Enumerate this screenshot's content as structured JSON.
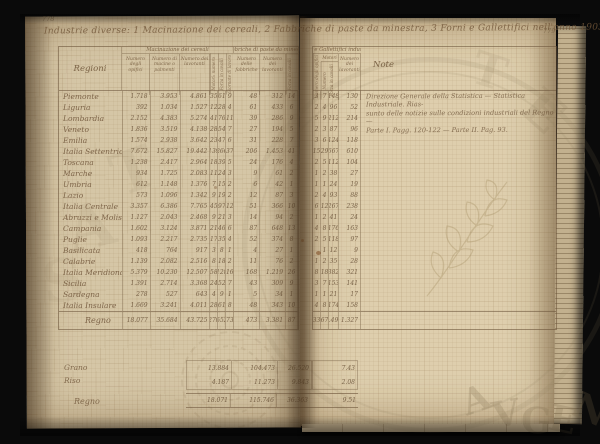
{
  "photo": {
    "background": "#0a0a0a",
    "page_color": "#d5c6a6",
    "ink_color": "#6f5a40",
    "line_color": "#685036",
    "seal_color": "#7d6b4c"
  },
  "pages": {
    "left_number": "778",
    "right_number": "779"
  },
  "title": "Industrie diverse: 1 Macinazione dei cereali, 2 Fabbriche di paste da minestra, 3 Forni e Gallettifici nell'anno 1903",
  "table": {
    "region_header": "Regioni",
    "motori_label": "Motori",
    "note_header": "Note",
    "groups": [
      {
        "label": "Macinazione dei cereali"
      },
      {
        "label": "Fabbriche di paste da minestra"
      },
      {
        "label": "Forni e Gallettifici industriali"
      }
    ],
    "columns_left": [
      {
        "label": "Numero degli opifici",
        "rotated": false
      },
      {
        "label": "Numero di macine o palmenti",
        "rotated": false
      },
      {
        "label": "Numero dei lavoranti",
        "rotated": false
      },
      {
        "label": "Motori: numero",
        "rotated": true
      },
      {
        "label": "Forza in cavalli",
        "rotated": true
      },
      {
        "label": "Giornate di lavoro",
        "rotated": true
      },
      {
        "label": "Numero delle fabbriche",
        "rotated": false
      },
      {
        "label": "Numero dei lavoranti",
        "rotated": false
      },
      {
        "label": "Forza in cavalli",
        "rotated": true
      }
    ],
    "columns_right": [
      {
        "label": "Numero degli opifici",
        "rotated": true
      },
      {
        "label": "Numero",
        "rotated": true
      },
      {
        "label": "Forza in cavalli",
        "rotated": true
      },
      {
        "label": "Numero dei lavoranti",
        "rotated": false
      }
    ],
    "rows": [
      {
        "region": "Piemonte",
        "left": [
          "1.718",
          "3.953",
          "4.861",
          "35",
          "61",
          "9",
          "48",
          "312",
          "14"
        ],
        "right": [
          "3",
          "7",
          "148",
          "130"
        ]
      },
      {
        "region": "Liguria",
        "left": [
          "392",
          "1.034",
          "1.527",
          "12",
          "28",
          "4",
          "61",
          "433",
          "6"
        ],
        "right": [
          "2",
          "4",
          "96",
          "52"
        ]
      },
      {
        "region": "Lombardia",
        "left": [
          "2.152",
          "4.383",
          "5.274",
          "41",
          "76",
          "11",
          "39",
          "286",
          "9"
        ],
        "right": [
          "5",
          "9",
          "212",
          "214"
        ]
      },
      {
        "region": "Veneto",
        "left": [
          "1.836",
          "3.519",
          "4.138",
          "28",
          "54",
          "7",
          "27",
          "194",
          "5"
        ],
        "right": [
          "2",
          "3",
          "87",
          "96"
        ]
      },
      {
        "region": "Emilia",
        "left": [
          "1.574",
          "2.938",
          "3.642",
          "23",
          "47",
          "6",
          "31",
          "228",
          "7"
        ],
        "right": [
          "3",
          "6",
          "124",
          "118"
        ]
      },
      {
        "region": "Italia Settentrionale",
        "left": [
          "7.672",
          "15.827",
          "19.442",
          "139",
          "266",
          "37",
          "206",
          "1.453",
          "41"
        ],
        "right": [
          "15",
          "29",
          "667",
          "610"
        ]
      },
      {
        "region": "Toscana",
        "left": [
          "1.238",
          "2.417",
          "2.964",
          "18",
          "39",
          "5",
          "24",
          "176",
          "4"
        ],
        "right": [
          "2",
          "5",
          "112",
          "104"
        ]
      },
      {
        "region": "Marche",
        "left": [
          "934",
          "1.725",
          "2.083",
          "11",
          "24",
          "3",
          "9",
          "61",
          "2"
        ],
        "right": [
          "1",
          "2",
          "38",
          "27"
        ]
      },
      {
        "region": "Umbria",
        "left": [
          "612",
          "1.148",
          "1.376",
          "7",
          "15",
          "2",
          "6",
          "42",
          "1"
        ],
        "right": [
          "1",
          "1",
          "24",
          "19"
        ]
      },
      {
        "region": "Lazio",
        "left": [
          "573",
          "1.096",
          "1.342",
          "9",
          "19",
          "2",
          "12",
          "87",
          "3"
        ],
        "right": [
          "2",
          "4",
          "93",
          "88"
        ]
      },
      {
        "region": "Italia Centrale",
        "left": [
          "3.357",
          "6.386",
          "7.765",
          "45",
          "97",
          "12",
          "51",
          "366",
          "10"
        ],
        "right": [
          "6",
          "12",
          "267",
          "238"
        ]
      },
      {
        "region": "Abruzzi e Molise",
        "left": [
          "1.127",
          "2.043",
          "2.468",
          "9",
          "21",
          "3",
          "14",
          "94",
          "2"
        ],
        "right": [
          "1",
          "2",
          "41",
          "24"
        ]
      },
      {
        "region": "Campania",
        "left": [
          "1.602",
          "3.124",
          "3.871",
          "21",
          "46",
          "6",
          "87",
          "648",
          "13"
        ],
        "right": [
          "4",
          "8",
          "176",
          "163"
        ]
      },
      {
        "region": "Puglie",
        "left": [
          "1.093",
          "2.217",
          "2.735",
          "17",
          "35",
          "4",
          "52",
          "374",
          "8"
        ],
        "right": [
          "2",
          "5",
          "118",
          "97"
        ]
      },
      {
        "region": "Basilicata",
        "left": [
          "418",
          "764",
          "917",
          "3",
          "8",
          "1",
          "4",
          "27",
          "1"
        ],
        "right": [
          "",
          "1",
          "12",
          "9"
        ]
      },
      {
        "region": "Calabrie",
        "left": [
          "1.139",
          "2.082",
          "2.516",
          "8",
          "18",
          "2",
          "11",
          "76",
          "2"
        ],
        "right": [
          "1",
          "2",
          "35",
          "28"
        ]
      },
      {
        "region": "Italia Meridionale",
        "left": [
          "5.379",
          "10.230",
          "12.507",
          "58",
          "128",
          "16",
          "168",
          "1.219",
          "26"
        ],
        "right": [
          "8",
          "18",
          "382",
          "321"
        ]
      },
      {
        "region": "Sicilia",
        "left": [
          "1.391",
          "2.714",
          "3.368",
          "24",
          "52",
          "7",
          "43",
          "309",
          "9"
        ],
        "right": [
          "3",
          "7",
          "153",
          "141"
        ]
      },
      {
        "region": "Sardegna",
        "left": [
          "278",
          "527",
          "643",
          "4",
          "9",
          "1",
          "5",
          "34",
          "1"
        ],
        "right": [
          "1",
          "1",
          "21",
          "17"
        ]
      },
      {
        "region": "Italia Insulare",
        "left": [
          "1.669",
          "3.241",
          "4.011",
          "28",
          "61",
          "8",
          "48",
          "343",
          "10"
        ],
        "right": [
          "4",
          "8",
          "174",
          "158"
        ]
      }
    ],
    "total": {
      "region": "Regno",
      "left": [
        "18.077",
        "35.684",
        "43.725",
        "270",
        "552",
        "73",
        "473",
        "3.381",
        "87"
      ],
      "right": [
        "33",
        "67",
        "1.490",
        "1.327"
      ]
    }
  },
  "bottom_block": {
    "rows": [
      {
        "label": "Grano",
        "left": [
          "13.884",
          "104.473",
          "26.520"
        ],
        "right": "7.43"
      },
      {
        "label": "Riso",
        "left": [
          "4.187",
          "11.273",
          "9.843"
        ],
        "right": "2.08"
      }
    ],
    "total": {
      "label": "Regno",
      "left": [
        "18.071",
        "115.746",
        "36.363"
      ],
      "right": "9.51"
    }
  },
  "note_lines": [
    "Direzione Generale della Statistica — Statistica Industriale. Rias-",
    "sunto delle notizie sulle condizioni industriali del Regno —",
    "Parte I. Pagg. 120-122 — Parte II. Pag. 93."
  ],
  "seal": {
    "ring": {
      "cx": 430,
      "cy": 245,
      "r": 188
    },
    "letters": [
      {
        "ch": "T",
        "x": 472,
        "y": 48,
        "s": 46,
        "rot": 18,
        "o": 0.1
      },
      {
        "ch": "E",
        "x": 524,
        "y": 86,
        "s": 50,
        "rot": 42,
        "o": 0.13
      },
      {
        "ch": "A",
        "x": 462,
        "y": 382,
        "s": 36,
        "rot": -20,
        "o": 0.22
      },
      {
        "ch": "V",
        "x": 492,
        "y": 396,
        "s": 36,
        "rot": -10,
        "o": 0.22
      },
      {
        "ch": "G",
        "x": 521,
        "y": 403,
        "s": 36,
        "rot": 2,
        "o": 0.22
      },
      {
        "ch": "E",
        "x": 549,
        "y": 402,
        "s": 36,
        "rot": 12,
        "o": 0.22
      },
      {
        "ch": "N",
        "x": 574,
        "y": 392,
        "s": 36,
        "rot": 24,
        "o": 0.22
      },
      {
        "ch": "A",
        "x": 66,
        "y": 196,
        "s": 62,
        "rot": -14,
        "o": 0.08
      },
      {
        "ch": "T",
        "x": 112,
        "y": 142,
        "s": 58,
        "rot": -20,
        "o": 0.08
      },
      {
        "ch": "S",
        "x": 42,
        "y": 252,
        "s": 58,
        "rot": -8,
        "o": 0.07
      }
    ]
  }
}
